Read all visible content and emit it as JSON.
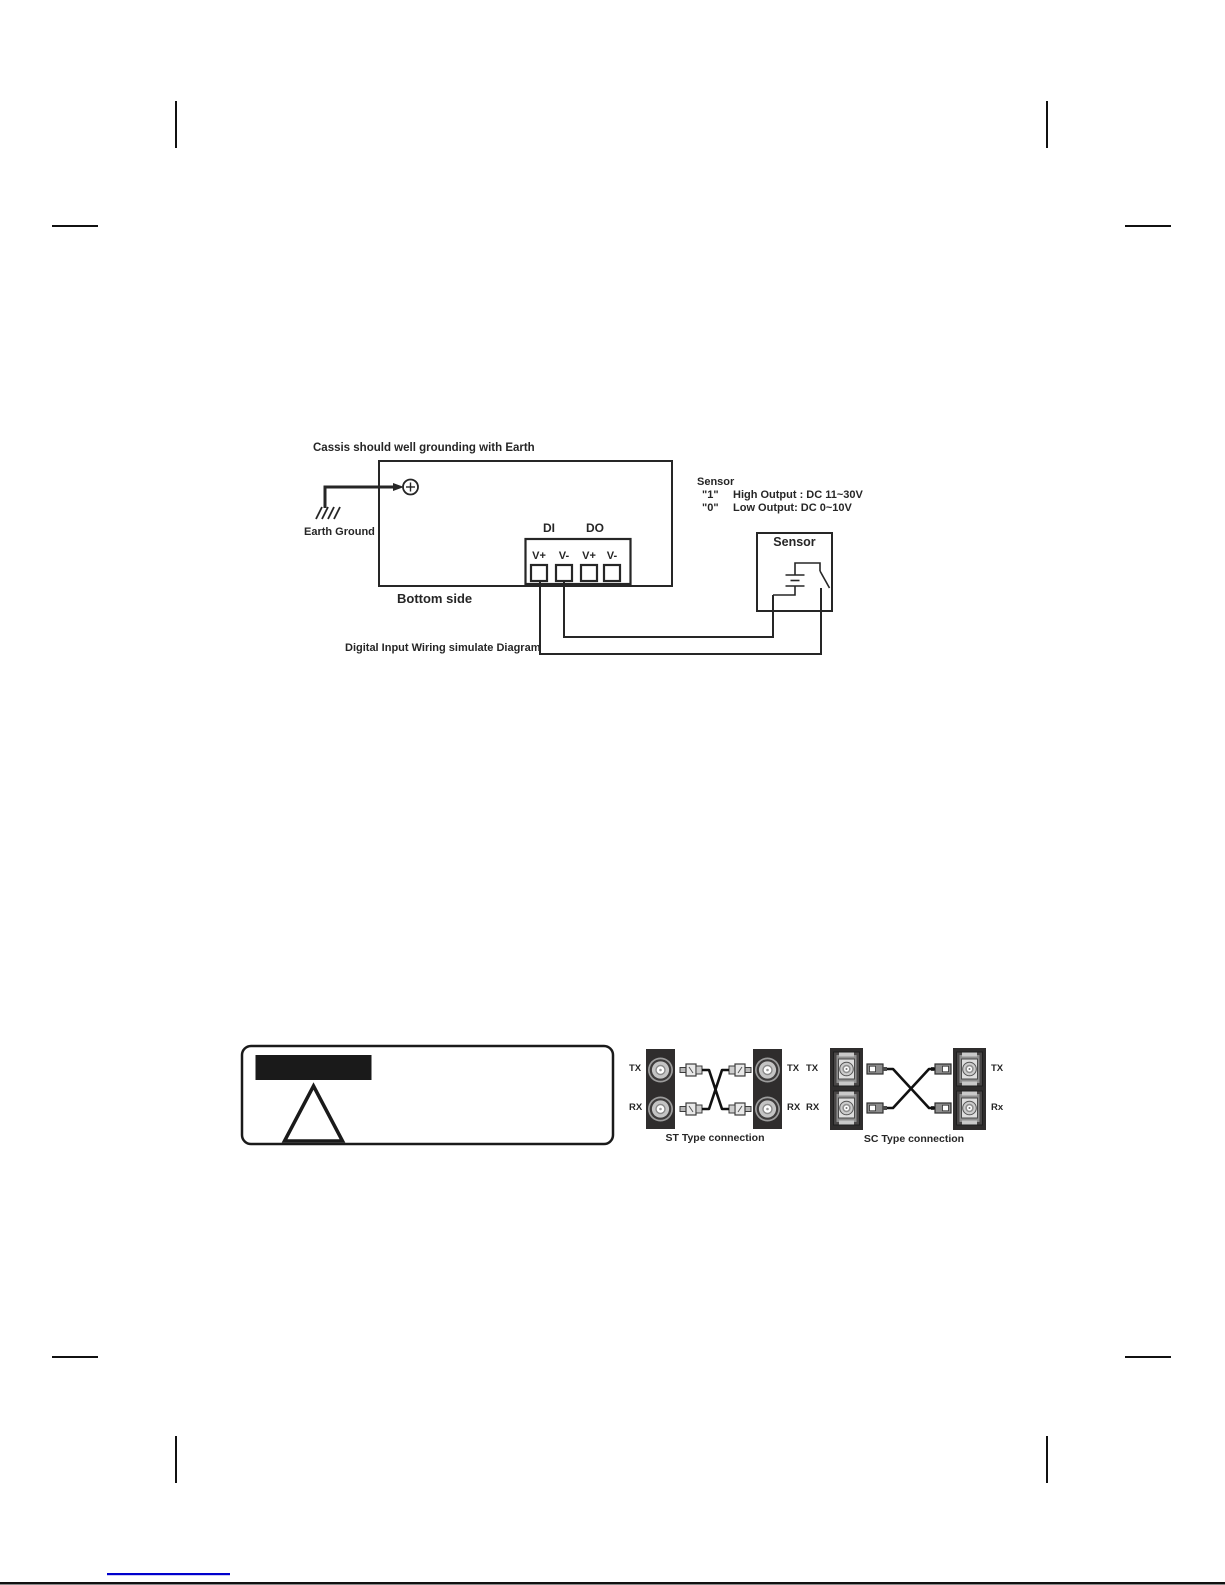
{
  "document": {
    "wiring": {
      "grounding_note": "Cassis should well grounding with Earth",
      "earth_ground": "Earth Ground",
      "group_di": "DI",
      "group_do": "DO",
      "pins": [
        "V+",
        "V-",
        "V+",
        "V-"
      ],
      "bottom_side": "Bottom side",
      "caption": "Digital Input Wiring simulate Diagram",
      "sensor_title": "Sensor",
      "sensor_levels": [
        {
          "level": "\"1\"",
          "desc": "High Output : DC 11~30V"
        },
        {
          "level": "\"0\"",
          "desc": "Low Output: DC 0~10V"
        }
      ],
      "sensor_box": "Sensor"
    },
    "fiber": {
      "st_caption": "ST Type connection",
      "sc_caption": "SC Type connection",
      "st_left": [
        "TX",
        "RX"
      ],
      "st_right": [
        "TX",
        "RX"
      ],
      "sc_left": [
        "TX",
        "RX"
      ],
      "sc_right": [
        "TX",
        "Rx"
      ]
    },
    "colors": {
      "ink": "#262626",
      "panel_dark": "#2f2d2d",
      "link_blue": "#0000cc"
    }
  }
}
